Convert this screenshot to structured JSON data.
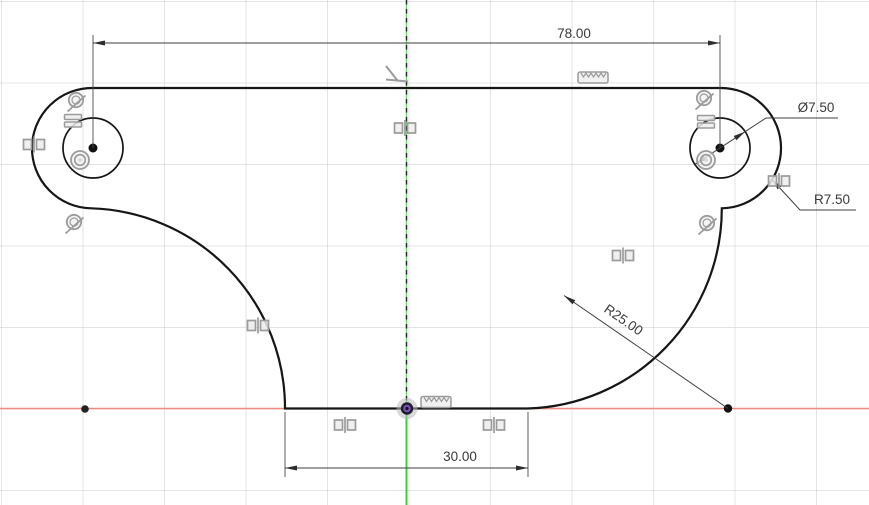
{
  "canvas": {
    "background_color": "#ffffff",
    "grid_color": "#cbd0d4",
    "x_axis_color": "#ee8a80",
    "y_axis_color": "#3fca3f",
    "profile_fill_color": "#eaf3f8",
    "edge_color": "#161616",
    "constraint_icon_color": "#9b9b9b",
    "dimension_text_color": "#3a3a3a",
    "origin_point_color": "#7a52b8"
  },
  "dimensions": {
    "hole_spacing": {
      "label": "78.00"
    },
    "hole_diameter": {
      "label": "Ø7.50"
    },
    "end_radius": {
      "label": "R7.50"
    },
    "side_radius": {
      "label": "R25.00"
    },
    "base_width": {
      "label": "30.00"
    }
  },
  "constraints": {
    "types": [
      "tangent",
      "equal",
      "concentric",
      "symmetry",
      "perpendicular",
      "ruler"
    ]
  }
}
